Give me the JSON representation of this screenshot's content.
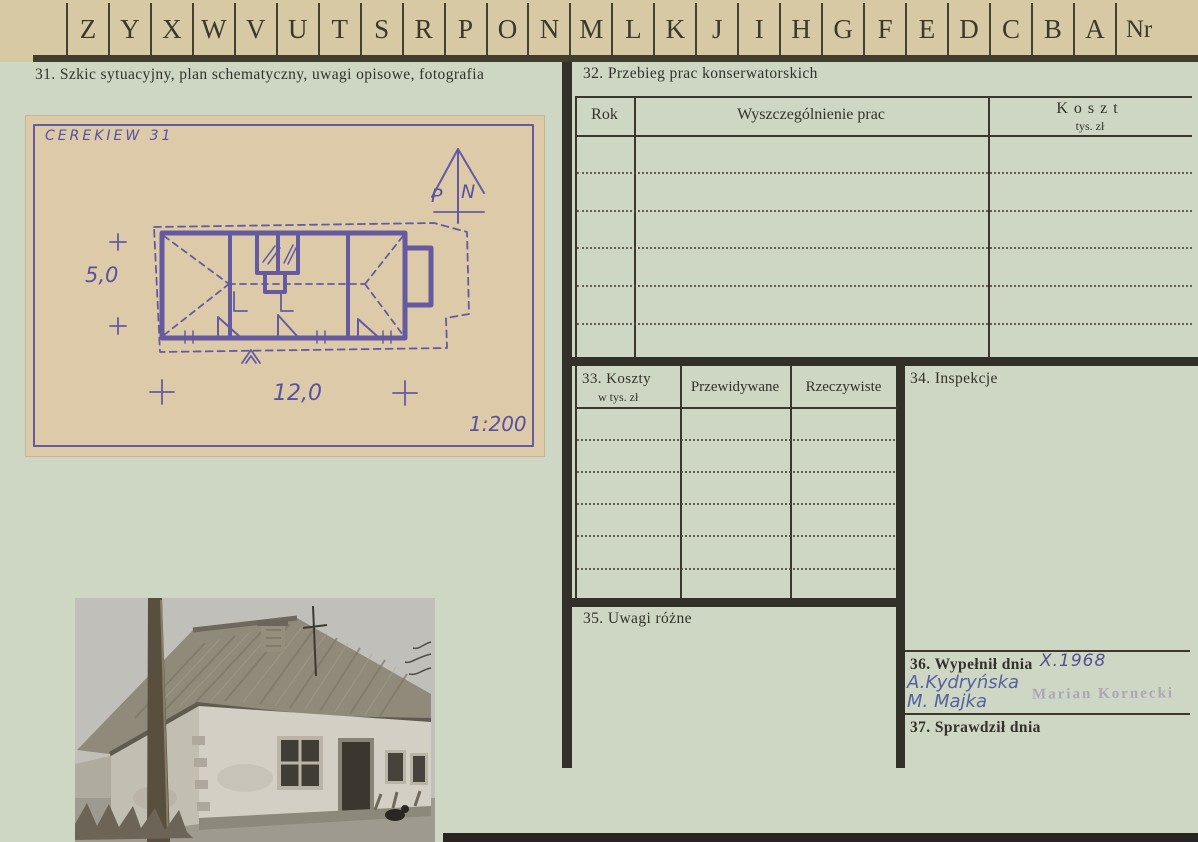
{
  "colors": {
    "card_top": "#d6c9a3",
    "card_body": "#cdd7c4",
    "printed_ink": "#33312a",
    "sketch_paper": "#dccaa9",
    "sketch_ink": "#5a509f",
    "handwriting_ink": "#5a5fa0",
    "stamp_ink": "#9d90b5"
  },
  "index_row": {
    "letters": [
      "Z",
      "Y",
      "X",
      "W",
      "V",
      "U",
      "T",
      "S",
      "R",
      "P",
      "O",
      "N",
      "M",
      "L",
      "K",
      "J",
      "I",
      "H",
      "G",
      "F",
      "E",
      "D",
      "C",
      "B",
      "A"
    ],
    "nr": "Nr"
  },
  "section31": {
    "title": "31. Szkic sytuacyjny, plan schematyczny, uwagi opisowe, fotografia",
    "sketch": {
      "caption": "CEREKIEW 31",
      "north_p": "P",
      "north_n": "N",
      "dim_height": "5,0",
      "dim_width": "12,0",
      "scale": "1:200"
    },
    "photo_alt": "Czarno-biała fotografia chałupy krytej strzechą ze słupem drewnianym"
  },
  "section32": {
    "title": "32. Przebieg prac konserwatorskich",
    "col_rok": "Rok",
    "col_prace": "Wyszczególnienie prac",
    "col_koszt": "Koszt",
    "col_koszt_sub": "tys. zł"
  },
  "section33": {
    "title": "33. Koszty",
    "title_sub": "w tys. zł",
    "col_przewidywane": "Przewidywane",
    "col_rzeczywiste": "Rzeczywiste"
  },
  "section34": {
    "title": "34. Inspekcje"
  },
  "section35": {
    "title": "35. Uwagi różne"
  },
  "section36": {
    "title": "36. Wypełnił dnia",
    "date": "X.1968",
    "signature1": "A.Kydryńska",
    "signature2": "M. Majka",
    "stamp": "Marian Kornecki"
  },
  "section37": {
    "title": "37. Sprawdził dnia"
  }
}
